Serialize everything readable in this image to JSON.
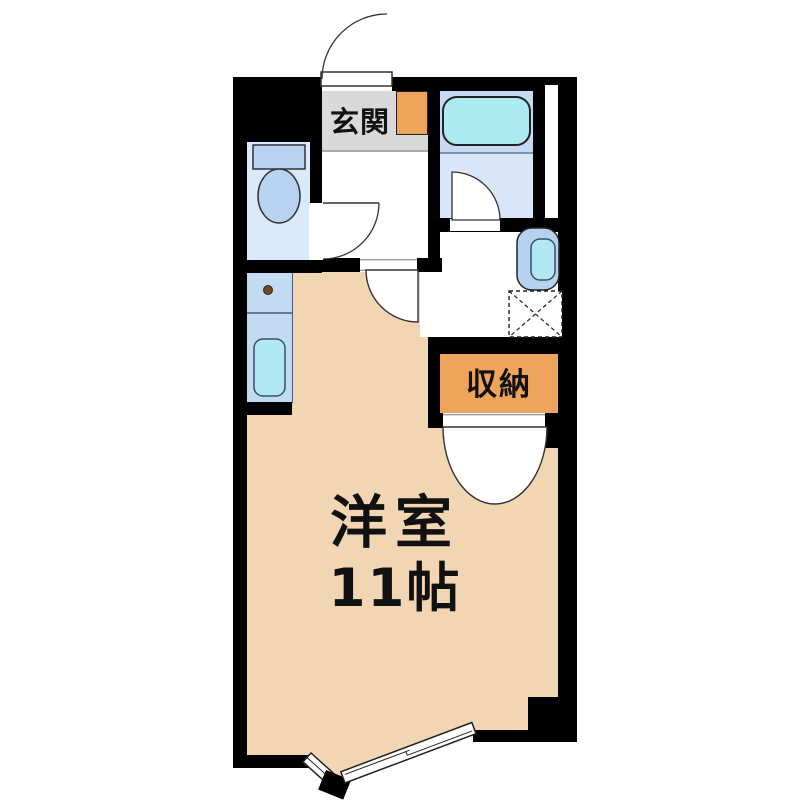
{
  "plan_title": "floor-plan",
  "rooms": {
    "genkan": {
      "label": "玄関"
    },
    "storage": {
      "label": "収納"
    },
    "main_room": {
      "name": "洋室",
      "size": "11帖"
    }
  },
  "fixtures": {
    "toilet": "toilet",
    "bathtub": "bathtub",
    "kitchen_sink": "kitchen-sink",
    "burner_dot": "burner-dot",
    "washbasin": "washbasin",
    "washing_machine_pan": "washing-machine-pan",
    "entrance_door": "entrance-door",
    "toilet_door": "toilet-door",
    "bathroom_door": "bathroom-door",
    "room_door": "room-door",
    "closet_double_doors": "closet-double-doors",
    "balcony_sliding_window": "balcony-sliding-window"
  },
  "colors": {
    "wall": "#000000",
    "room_peach": "#f2d6b4",
    "genkan_gray": "#d9d9d9",
    "accent_orange": "#efa45c",
    "toilet_room": "#dbeafa",
    "fixture_blue": "#b8d3f2",
    "counter_blue": "#c3daf3",
    "sink_cyan": "#b2e8f2",
    "bath_upper": "#c6daf3",
    "bath_lower": "#d9e6f8",
    "tub_cyan": "#aeeaf2",
    "basin_outer": "#b7d2ec"
  }
}
